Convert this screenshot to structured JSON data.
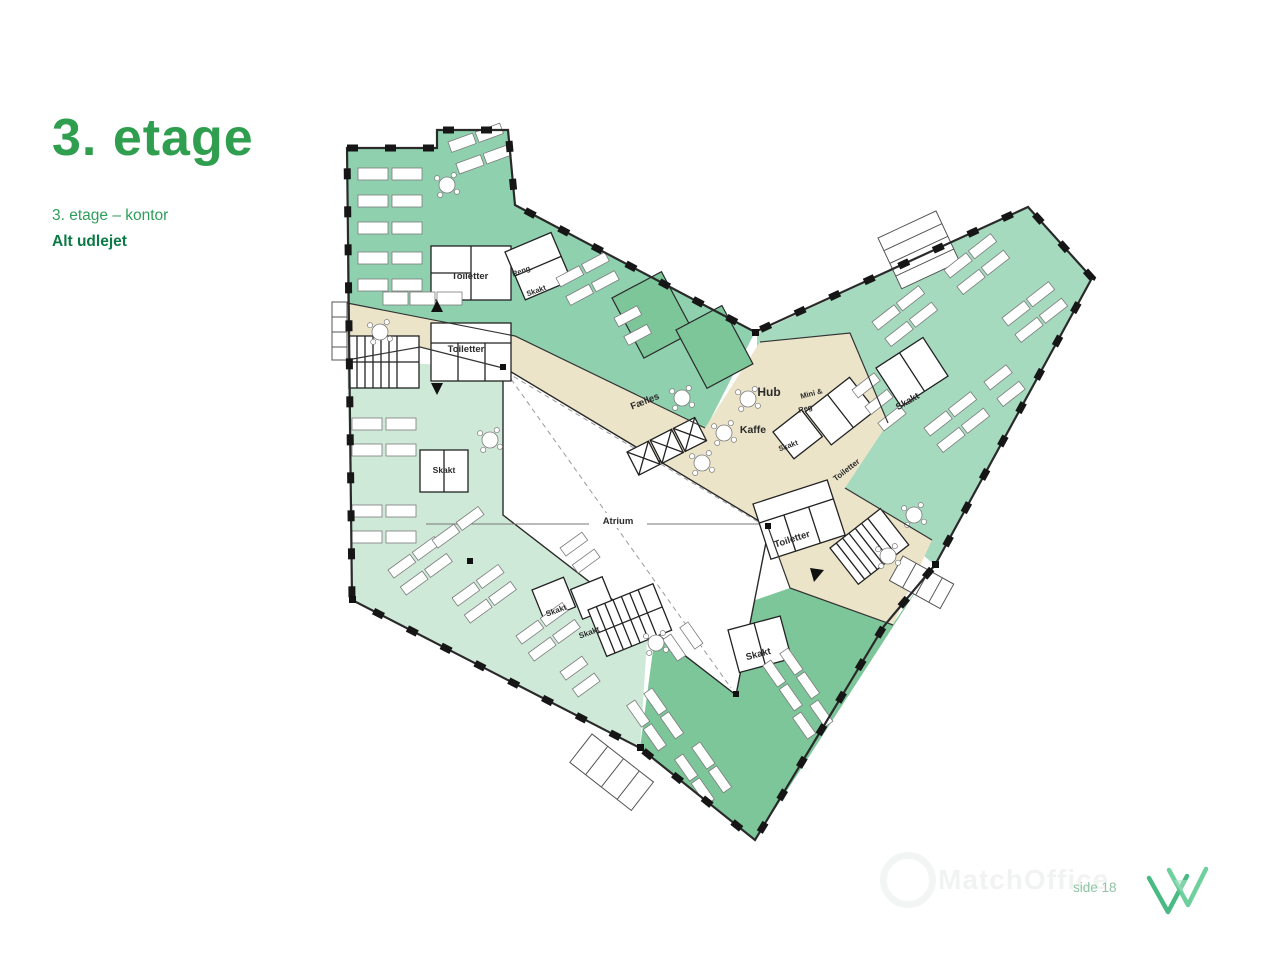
{
  "header": {
    "title": "3. etage",
    "subtitle": "3. etage – kontor",
    "status": "Alt udlejet"
  },
  "floorplan": {
    "labels": [
      {
        "text": "Toiletter"
      },
      {
        "text": "Reng."
      },
      {
        "text": "Skakt"
      },
      {
        "text": "Toiletter"
      },
      {
        "text": "Skakt"
      },
      {
        "text": "Fælles"
      },
      {
        "text": "Hub"
      },
      {
        "text": "Mini &"
      },
      {
        "text": "Reg"
      },
      {
        "text": "Kaffe"
      },
      {
        "text": "Skakt"
      },
      {
        "text": "Toiletter"
      },
      {
        "text": "Atrium"
      },
      {
        "text": "Toiletter"
      },
      {
        "text": "Skakt"
      },
      {
        "text": "Skakt"
      },
      {
        "text": "Skakt"
      },
      {
        "text": "Skakt"
      }
    ]
  },
  "footer": {
    "watermark": "MatchOffice",
    "page_label": "side 18"
  },
  "colors": {
    "title_green": "#2f9e4e",
    "subtitle_green": "#2f9e5b",
    "status_green": "#0c7a46",
    "page_label_green": "#8fc3a4",
    "logo_green": "#4bbd85",
    "zone_medium_green": "#8fd0ae",
    "zone_right_green": "#a5dabf",
    "zone_light_green": "#cfe9d9",
    "zone_dark_green": "#7cc69a",
    "corridor_beige": "#ece4c9",
    "wall_dark": "#1f1f1f"
  }
}
